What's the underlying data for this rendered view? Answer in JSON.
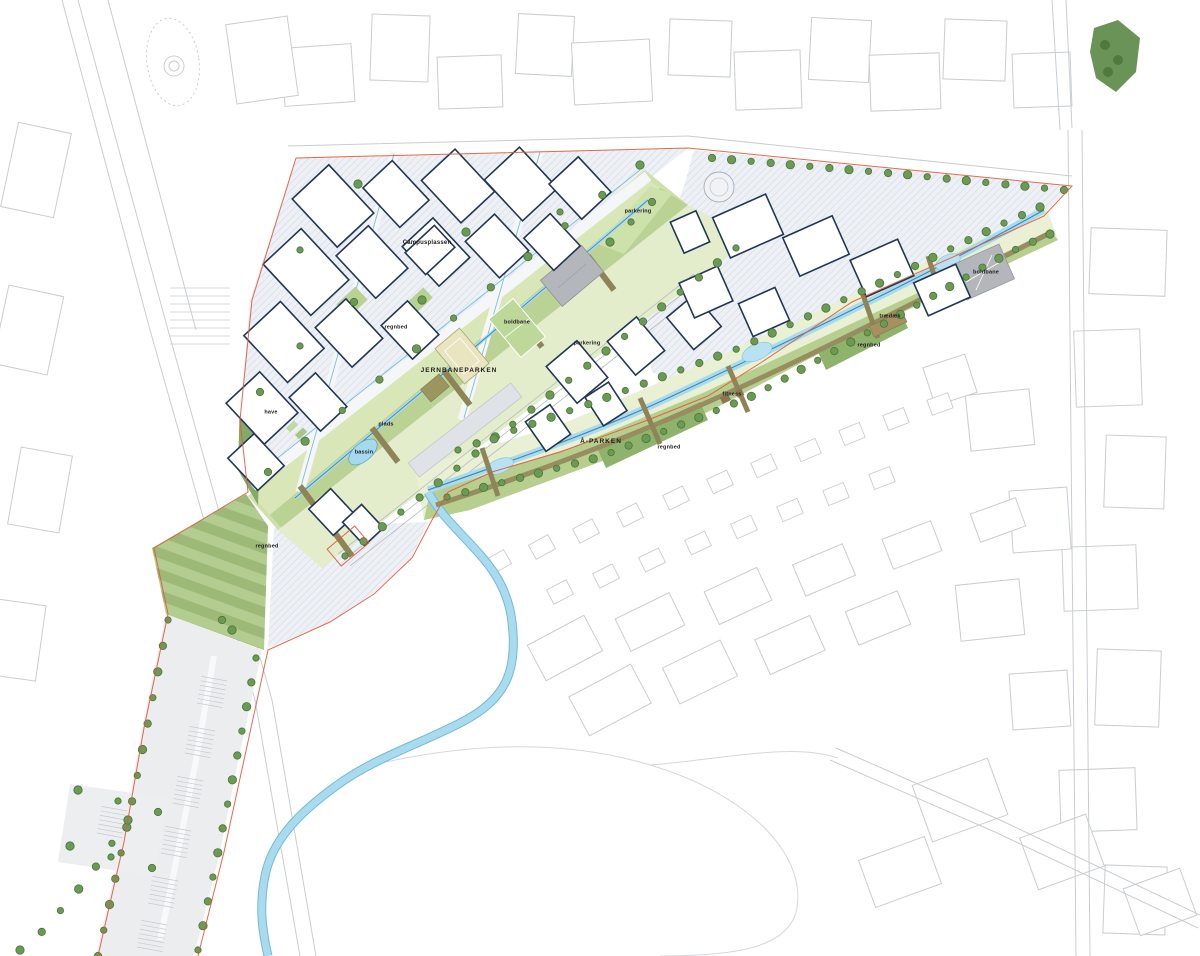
{
  "map": {
    "type": "urban-masterplan-site-plan",
    "labels": [
      {
        "t": "Campusplassen",
        "x": 427,
        "y": 243,
        "s": 6,
        "big": false
      },
      {
        "t": "regnbed",
        "x": 396,
        "y": 328,
        "s": 5.5,
        "big": false
      },
      {
        "t": "boldbane",
        "x": 517,
        "y": 323,
        "s": 5.5,
        "big": false
      },
      {
        "t": "JERNBANEPARKEN",
        "x": 459,
        "y": 371,
        "s": 6.5,
        "big": true
      },
      {
        "t": "parkering",
        "x": 638,
        "y": 212,
        "s": 5.5,
        "big": false
      },
      {
        "t": "parkering",
        "x": 587,
        "y": 344,
        "s": 5.5,
        "big": false
      },
      {
        "t": "have",
        "x": 271,
        "y": 413,
        "s": 5.5,
        "big": false
      },
      {
        "t": "plads",
        "x": 386,
        "y": 425,
        "s": 5.5,
        "big": false
      },
      {
        "t": "bassin",
        "x": 364,
        "y": 453,
        "s": 5.5,
        "big": false
      },
      {
        "t": "Å-PARKEN",
        "x": 601,
        "y": 442,
        "s": 6.5,
        "big": true
      },
      {
        "t": "regnbed",
        "x": 669,
        "y": 448,
        "s": 5.5,
        "big": false
      },
      {
        "t": "fitness",
        "x": 732,
        "y": 395,
        "s": 5.5,
        "big": false
      },
      {
        "t": "regnbed",
        "x": 869,
        "y": 346,
        "s": 5.5,
        "big": false
      },
      {
        "t": "trædæk",
        "x": 890,
        "y": 317,
        "s": 5.5,
        "big": false
      },
      {
        "t": "boldbane",
        "x": 986,
        "y": 273,
        "s": 5.5,
        "big": false
      },
      {
        "t": "regnbed",
        "x": 267,
        "y": 547,
        "s": 5.5,
        "big": false
      }
    ],
    "colors": {
      "boundary": "#e2593b",
      "water": "#a9dbee",
      "water_dark": "#4187b0",
      "water_edge": "#74b9d8",
      "tree": "#6a9a53",
      "tree_edge": "#4c7539",
      "park_pale": "#e9f0d3",
      "park_light": "#cfe1ab",
      "park_mid": "#b6cf8f",
      "park_dark": "#8fb26d",
      "lawn_a": "#9cb977",
      "lawn_b": "#b3cc8f",
      "olive": "#8d8557",
      "deck": "#a59062",
      "building": "#223655",
      "ctx": "#c9cdd1",
      "hatch_line": "#c9d1de",
      "hatch_bg": "#edf0f5",
      "gray_block": "#b3b6ba",
      "court_tan": "#e9e5c1",
      "court_green": "#bed899"
    }
  }
}
